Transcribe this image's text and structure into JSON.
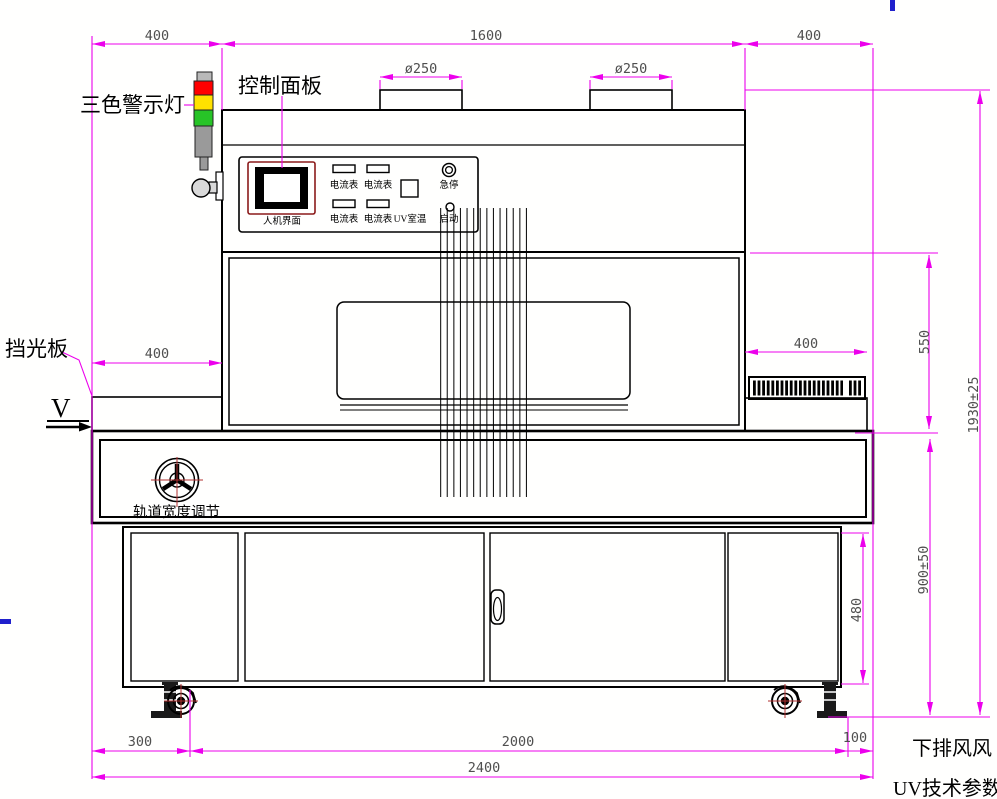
{
  "drawing": {
    "description": "UV curing conveyor machine front-view engineering drawing"
  },
  "labels": {
    "warning_light": "三色警示灯",
    "control_panel": "控制面板",
    "light_shield": "挡光板",
    "track_width_adjust": "轨道宽度调节",
    "view_marker": "V",
    "bottom_note_exhaust": "下排风风",
    "bottom_note_uv": "UV技术参数"
  },
  "panel": {
    "hmi_label": "人机界面",
    "ammeter_label": "电流表",
    "uv_temp_label": "UV室温",
    "estop_label": "急停",
    "start_label": "启动"
  },
  "dimensions": {
    "top_left": "400",
    "top_center": "1600",
    "top_right": "400",
    "port_left": "ø250",
    "port_right": "ø250",
    "mid_left": "400",
    "mid_right": "400",
    "height_chamber": "550",
    "height_base": "900±50",
    "height_total": "1930±25",
    "cabinet_height": "480",
    "bottom_left": "300",
    "bottom_center": "2000",
    "bottom_right": "100",
    "bottom_total": "2400"
  },
  "colors": {
    "dimension_line": "#ec00ec",
    "dimension_text": "#4f4f4f",
    "tower_red": "#ff0000",
    "tower_yellow": "#ffe100",
    "tower_green": "#27c427",
    "tower_gray": "#9a9a9a",
    "accent_blue": "#2020cc",
    "hmi_frame": "#8b1a1a",
    "crosshair_red": "#b03030"
  }
}
